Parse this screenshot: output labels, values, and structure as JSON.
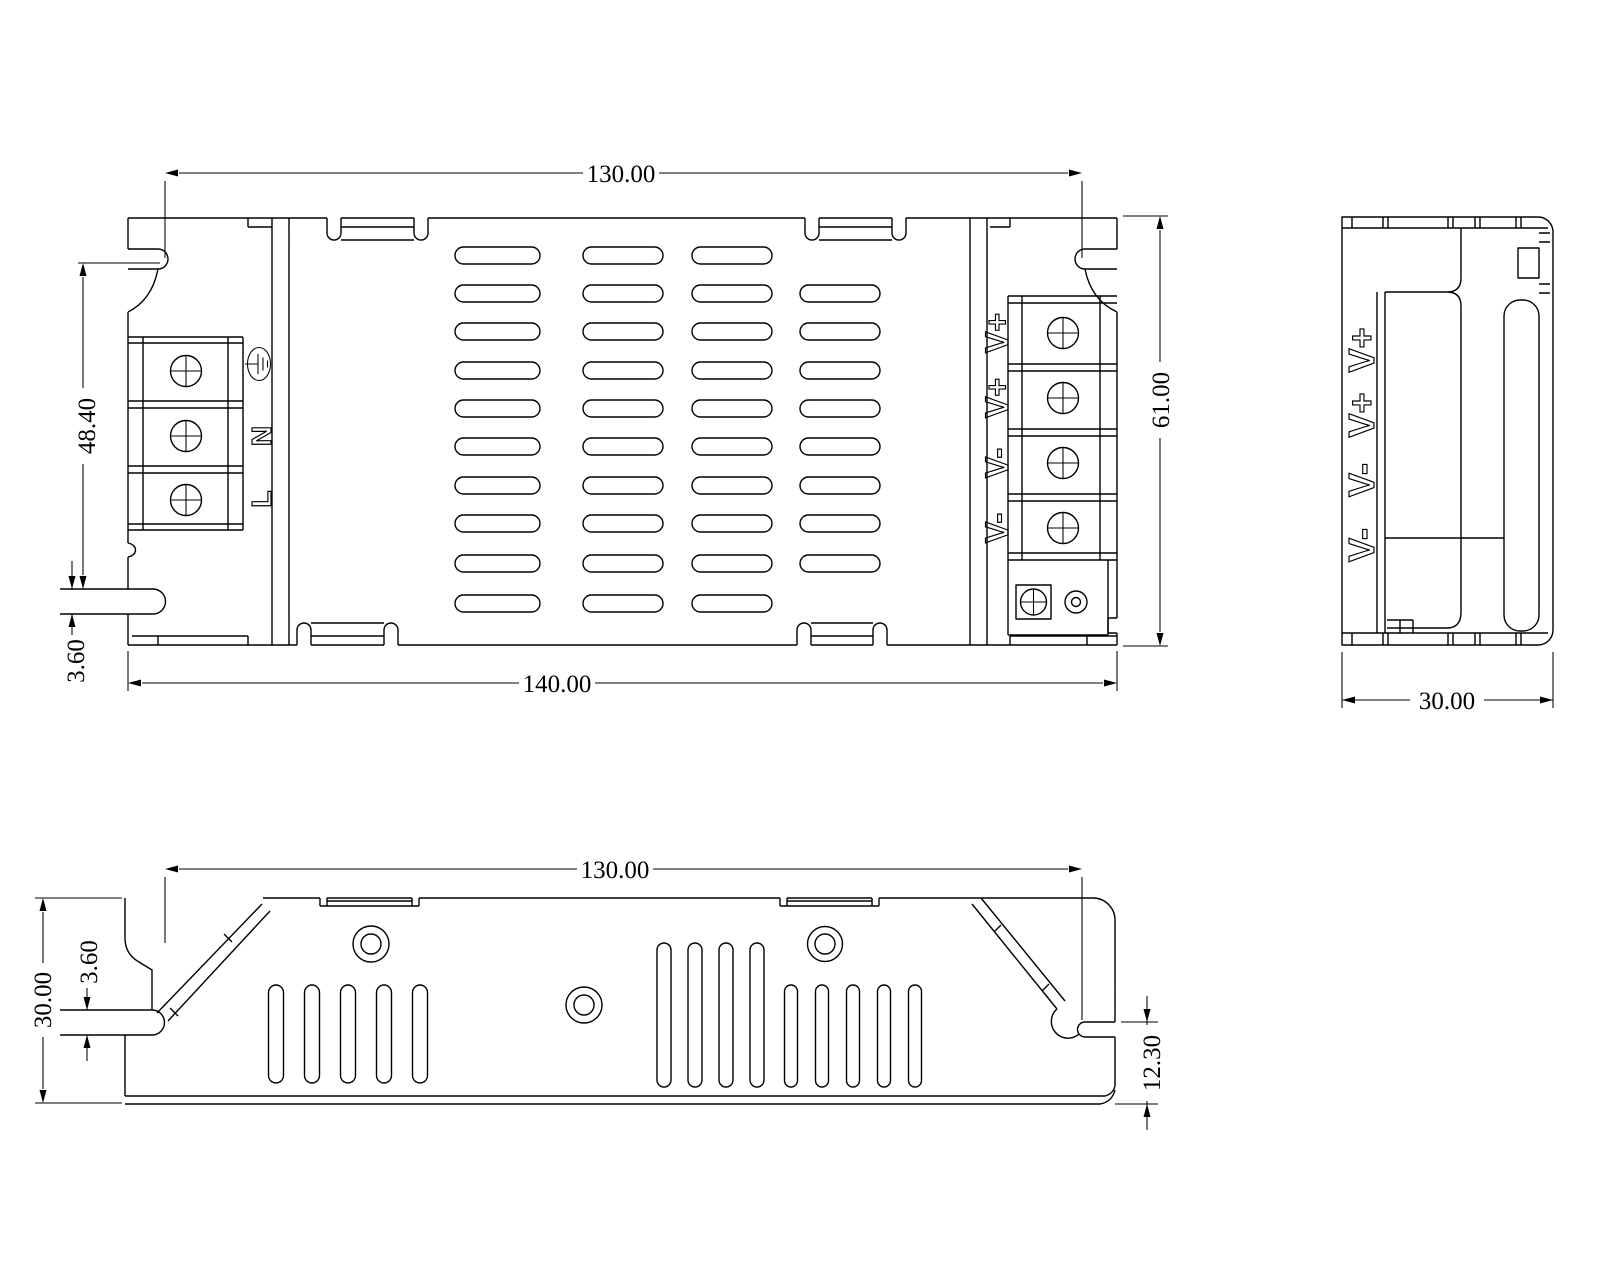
{
  "page": {
    "background": "#ffffff",
    "line_color": "#000000"
  },
  "views": {
    "top": {
      "dims": {
        "mounting_width": "130.00",
        "overall_width": "140.00",
        "left_height": "48.40",
        "left_slot_height": "3.60",
        "overall_height": "61.00"
      },
      "input_terminal": {
        "ground_icon": "earth-ground-icon",
        "n_label": "N",
        "l_label": "L"
      },
      "output_terminal": {
        "labels": [
          "V+",
          "V+",
          "V-",
          "V-"
        ]
      }
    },
    "side": {
      "dims": {
        "overall_depth": "30.00"
      },
      "output_labels": [
        "V+",
        "V+",
        "V-",
        "V-"
      ]
    },
    "bottom": {
      "dims": {
        "mounting_width": "130.00",
        "overall_height": "30.00",
        "slot_height": "3.60",
        "corner_height": "12.30"
      }
    }
  }
}
